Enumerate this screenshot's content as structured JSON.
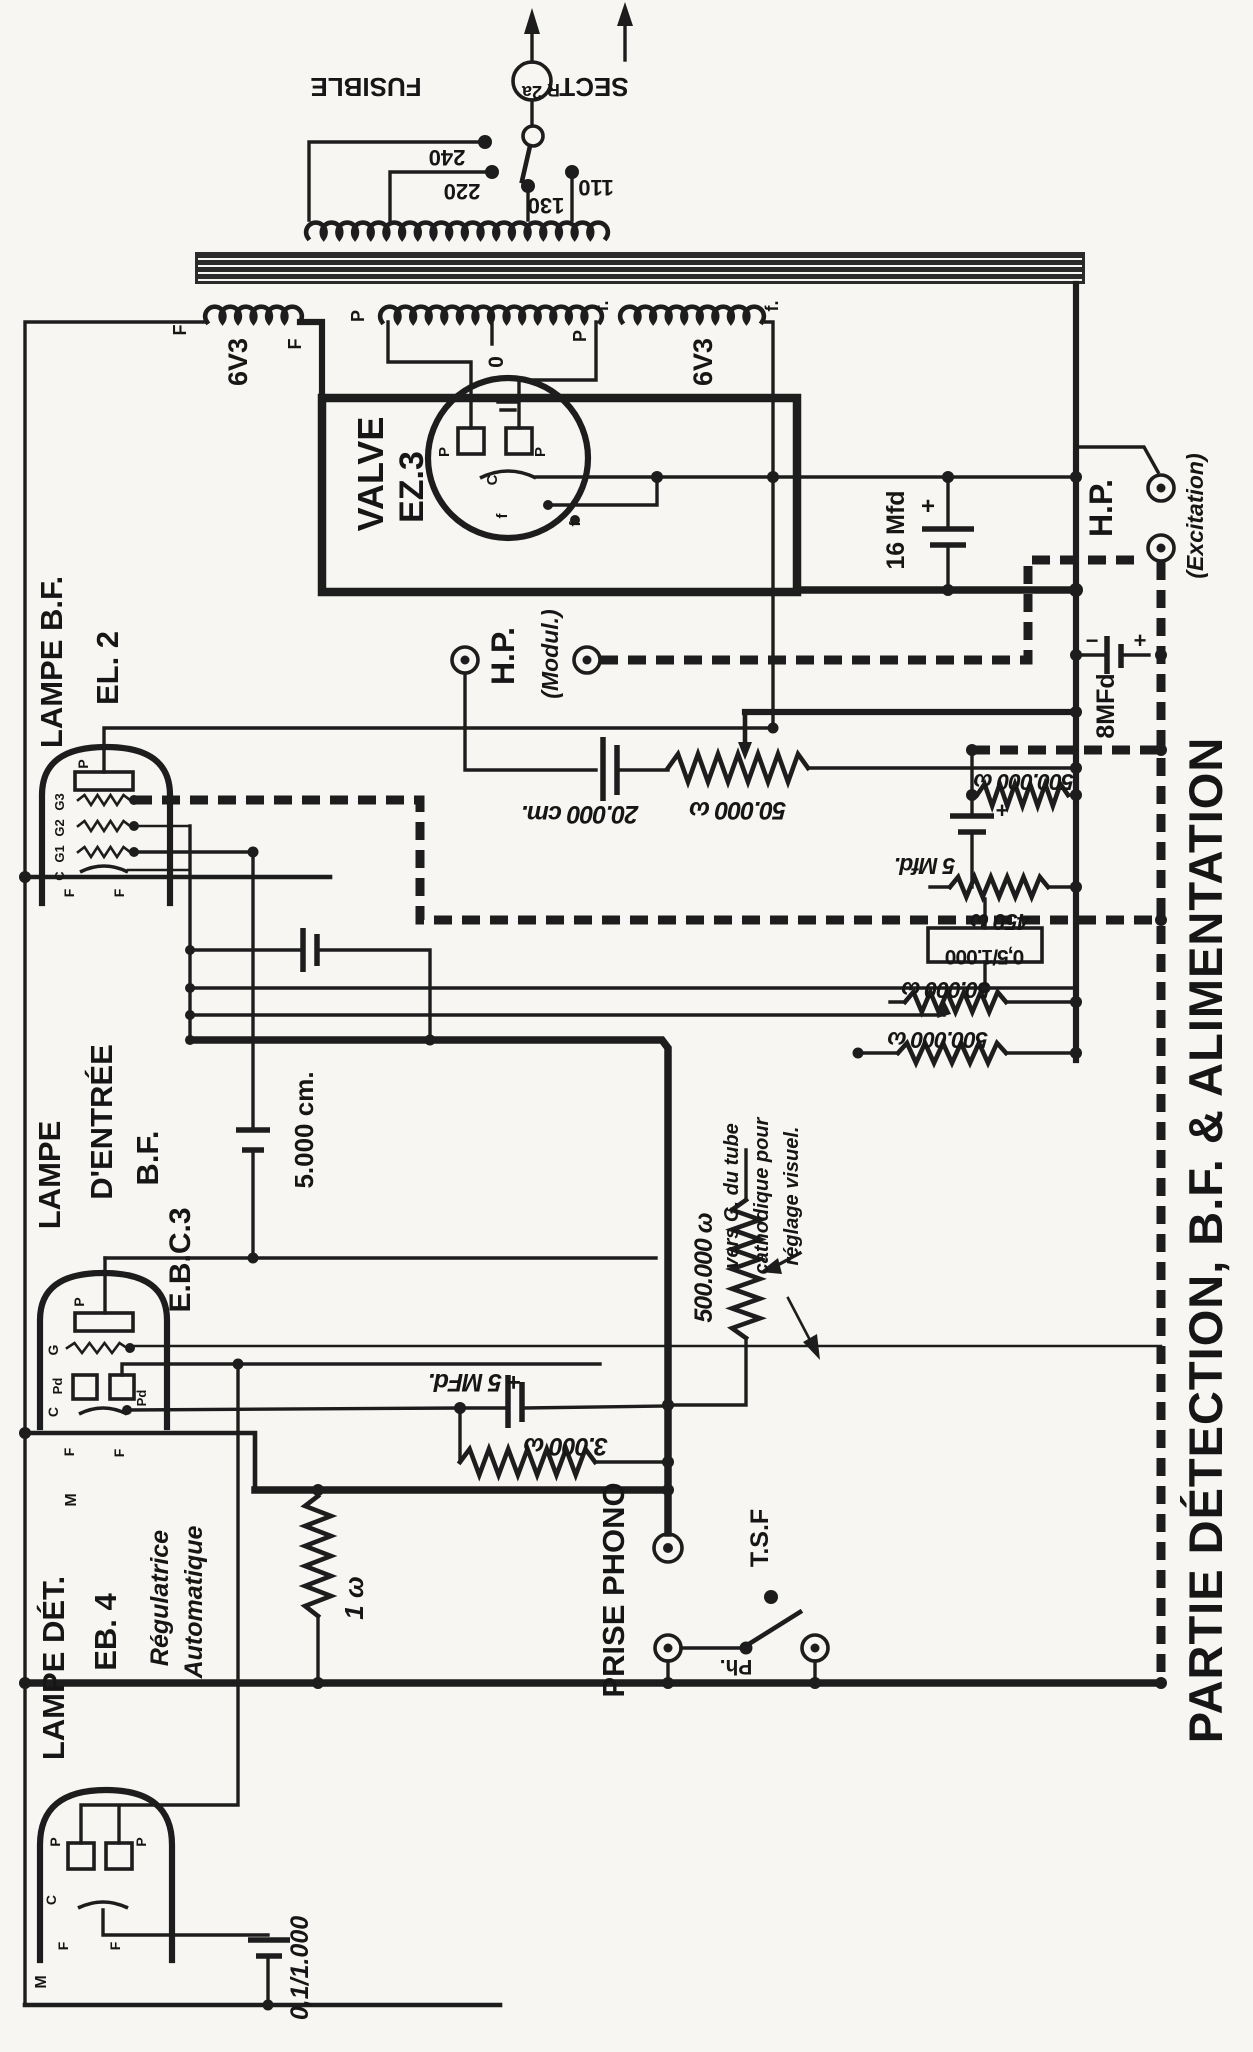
{
  "title": "PARTIE DÉTECTION, B.F. & ALIMENTATION",
  "labels": {
    "sect": "SECTᴿ",
    "fusible": "FUSIBLE",
    "fuse_rating": "2a",
    "tap240": "240",
    "tap220": "220",
    "tap130": "130",
    "tap110": "110",
    "heater_f_left": "F",
    "heater_6v3": "6V3",
    "heater_f_right": "F",
    "ht_p_left": "P",
    "ht_zero": "0",
    "ht_p_right": "P",
    "rect_f_left": "f.",
    "rect_f_right": "f.",
    "rect_6v3": "6V3",
    "valve": "VALVE",
    "valve_type": "EZ.3",
    "ez_p1": "P",
    "ez_p2": "P",
    "ez_c": "C",
    "ez_f1": "f",
    "ez_f2": "f",
    "c16": "16 Mfd",
    "c16_plus": "+",
    "hp_modul": "H.P.",
    "hp_modul_sub": "(Modul.)",
    "hp_exc": "H.P.",
    "hp_exc_sub": "(Excitation)",
    "c20000": "20.000 cm.",
    "r50000_top": "50.000 ω",
    "el2_name": "LAMPE B.F.",
    "el2_type": "EL. 2",
    "el2_p": "P",
    "el2_g3": "G3",
    "el2_g2": "G2",
    "el2_g1": "G1",
    "el2_c": "C",
    "el2_f1": "F",
    "el2_f2": "F",
    "c5000": "5.000 cm.",
    "ebc3_l1": "LAMPE",
    "ebc3_l2": "D'ENTRÉE",
    "ebc3_l3": "B.F.",
    "ebc3_type": "E.B.C.3",
    "ebc3_p": "P",
    "ebc3_g": "G",
    "ebc3_pd1": "Pd",
    "ebc3_pd2": "Pd",
    "ebc3_c": "C",
    "ebc3_f1": "F",
    "ebc3_f2": "F",
    "ebc3_m": "M",
    "bias_cap": "+ 5 MFd.",
    "bias_res": "3.000 ω",
    "prise_phono": "PRISE PHONO",
    "tsf": "T.S.F",
    "ph": "Ph.",
    "r1": "1 ω",
    "eb4_l1": "LAMPE DÉT.",
    "eb4_type": "EB. 4",
    "reg1": "Régulatrice",
    "reg2": "Automatique",
    "eb4_p1": "P",
    "eb4_p2": "P",
    "eb4_c": "C",
    "eb4_f1": "F",
    "eb4_f2": "F",
    "eb4_m": "M",
    "c01": "0,1/1.000",
    "c8": "8MFd",
    "c8_minus": "−",
    "c8_plus": "+",
    "r500a": "500.000 ω",
    "c5mfd": "5 Mfd.",
    "c5_plus": "+",
    "r450": "450 ω",
    "r05": "0,5/1.000",
    "r50b": "50.000 ω",
    "r500b": "500.000 ω",
    "crt1": "vers G. du tube",
    "crt2": "cathodique pour",
    "crt3": "réglage visuel.",
    "r500c": "500.000 ω"
  }
}
